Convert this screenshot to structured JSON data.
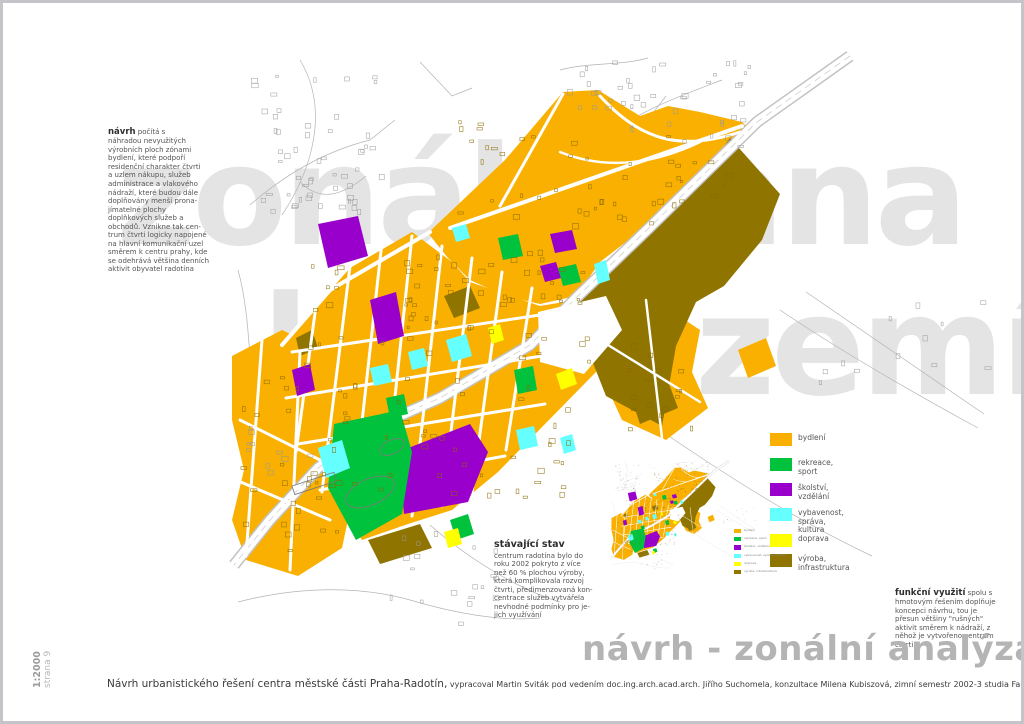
{
  "page": {
    "watermark_line1": "zonální ana",
    "watermark_line2": "lýza území",
    "title": "návrh - zonální analýza",
    "scale_label": "1:2000",
    "page_label": "strana 9",
    "caption_main": "Návrh urbanistického řešení centra městské části Praha-Radotín,",
    "caption_secondary": " vypracoval Martin Sviták pod vedením doc.ing.arch.acad.arch. Jiřího Suchomela, konzultace Milena Kubiszová, zimní semestr 2002-3 studia Fakulty architektury Technické university v Liberci"
  },
  "notes": {
    "navrh": {
      "heading": "návrh",
      "body": " počítá s\nnáhradou nevyužitých\nvýrobních ploch zónami\nbydlení, které podpoří\nresidenční charakter čtvrti\na uzlem nákupu, služeb\nadministrace a vlakového\nnádraží, které budou dále\ndoplňovány menší prona-\njímatelné plochy\ndoplňkových služeb a\nobchodů. Vznikne tak cen-\ntrum čtvrti logicky napojené\nna hlavní komunikační uzel\nsměrem k centru prahy, kde\nse odehrává většina denních\naktivit obyvatel radotína"
    },
    "stavajici": {
      "heading": "stávající stav",
      "body": "centrum radotína bylo do\nroku 2002 pokryto z více\nnež 60 % plochou výroby,\nkterá komplikovala rozvoj\nčtvrti, předimenzovaná kon-\ncentrace služeb vytvářela\nnevhodné podmínky pro je-\njich využívání"
    },
    "funkcni": {
      "heading": "funkční využití",
      "body": " spolu s\nhmotovým řešením doplňuje\nkoncepci návrhu, tou je\npřesun většiny \"rušných\"\naktivit směrem k nádraží, z\nněhož je vytvořeno centrum\nčtvrti"
    }
  },
  "legend": {
    "items": [
      {
        "label": "bydlení",
        "color": "#F9B000"
      },
      {
        "label": "rekreace, sport",
        "color": "#00C23C"
      },
      {
        "label": "školství, vzdělání",
        "color": "#9900CC"
      },
      {
        "label": "vybavenost, správa,\nkultura",
        "color": "#66FFFF"
      },
      {
        "label": "doprava",
        "color": "#FFFF00"
      },
      {
        "label": "výroba, infrastruktura",
        "color": "#8F7400"
      }
    ]
  },
  "map": {
    "zone_colors": {
      "bydleni": "#F9B000",
      "rekreace_sport": "#00C23C",
      "skolstvi_vzdelani": "#9900CC",
      "vybavenost_sprava_kultura": "#66FFFF",
      "doprava": "#FFFF00",
      "vyroba_infrastruktura": "#8F7400"
    }
  }
}
